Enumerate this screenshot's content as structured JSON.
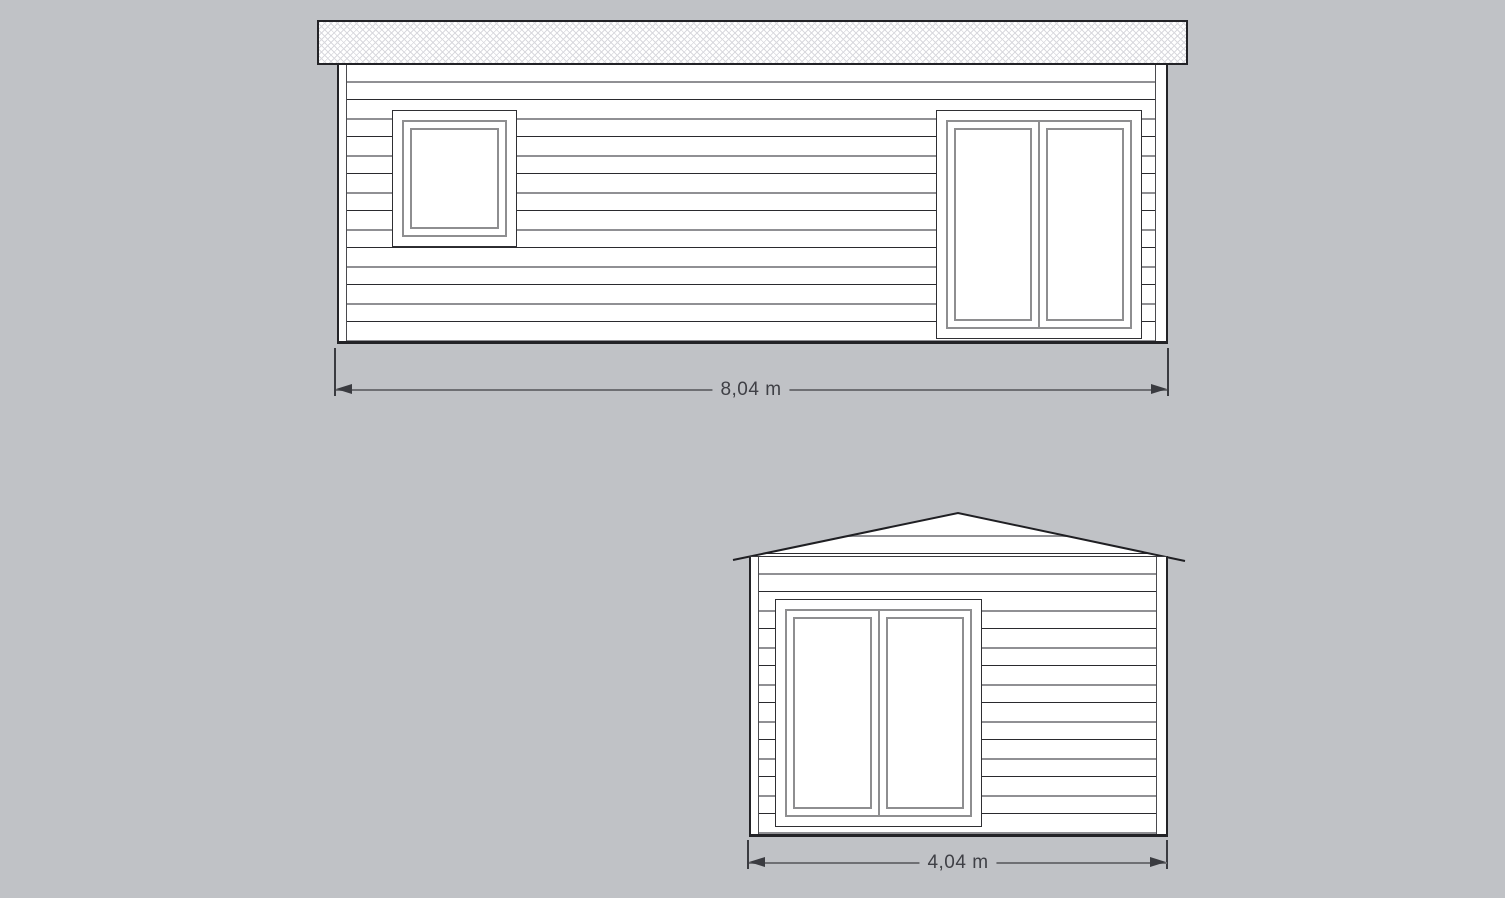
{
  "colors": {
    "background": "#c0c2c6",
    "outline": "#232327",
    "frame_gray": "#8e8e90",
    "hatch_line": "#d9d9de",
    "dimension_text": "#3f4046"
  },
  "elevations": {
    "side": {
      "width_label": "8,04 m"
    },
    "gable": {
      "width_label": "4,04 m"
    }
  }
}
